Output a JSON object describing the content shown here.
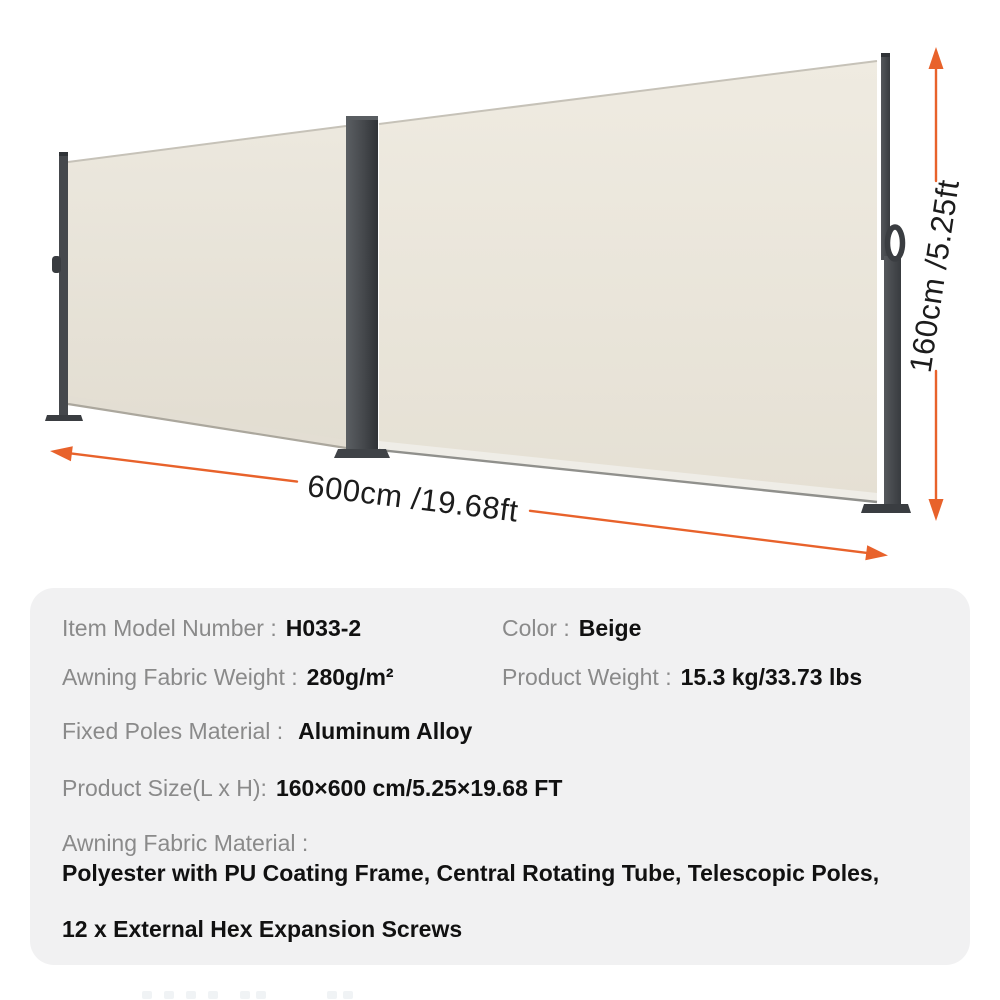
{
  "page": {
    "background": "#FFFFFF"
  },
  "annotations": {
    "width_label": "600cm /19.68ft",
    "height_label": "160cm /5.25ft",
    "accent_color": "#E8622B",
    "text_color": "#1C1C1C"
  },
  "product": {
    "kind": "retractable double side awning illustration",
    "fabric_color_hex": "#EAE5DA",
    "pole_color_hex": "#45484C"
  },
  "specs": {
    "panel_bg": "#F1F1F2",
    "label_color": "#8A8A8A",
    "value_color": "#111111",
    "item_model": {
      "label": "Item Model Number :",
      "value": "H033-2"
    },
    "color": {
      "label": "Color :",
      "value": "Beige"
    },
    "fabric_weight": {
      "label": "Awning Fabric Weight :",
      "value": "280g/m²"
    },
    "product_weight": {
      "label": "Product Weight :",
      "value": "15.3 kg/33.73 lbs"
    },
    "poles_material": {
      "label": "Fixed Poles Material :",
      "value": "Aluminum Alloy"
    },
    "product_size": {
      "label": "Product Size(L x H):",
      "value": "160×600 cm/5.25×19.68 FT"
    },
    "fabric_material": {
      "label": "Awning Fabric Material :",
      "line1": "Polyester with PU Coating Frame, Central Rotating Tube, Telescopic Poles,",
      "line2": "12 x External Hex Expansion Screws"
    }
  }
}
